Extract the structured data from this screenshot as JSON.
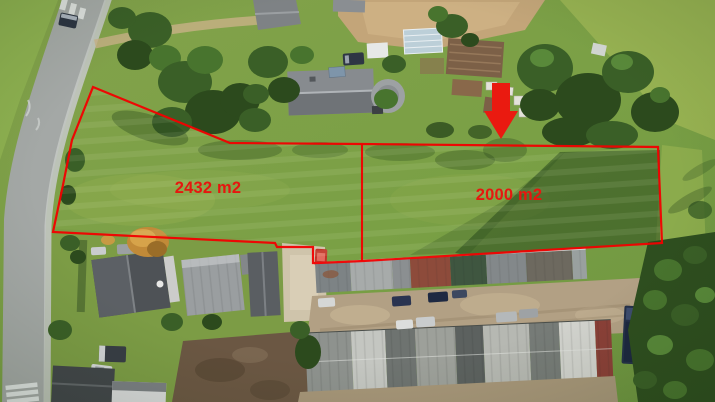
{
  "annotation": {
    "line_color": "#f20000",
    "label_color": "#e6170f",
    "arrow_color": "#ea1a10",
    "outer_boundary_points": "93,87 230,143 362,144 658,147 662,243 363,261 318,263 313,263 313,247 277,247 275,243 53,232 63,185 72,140",
    "divider_line_points": "362,144 362,261",
    "arrow_points": "492,83 510,83 510,111 518,111 501,139 484,111 492,111",
    "parcels": [
      {
        "position": "left",
        "area_label": "2432 m2",
        "label_x": 208,
        "label_y": 193
      },
      {
        "position": "right",
        "area_label": "2000 m2",
        "label_x": 509,
        "label_y": 200
      }
    ]
  }
}
